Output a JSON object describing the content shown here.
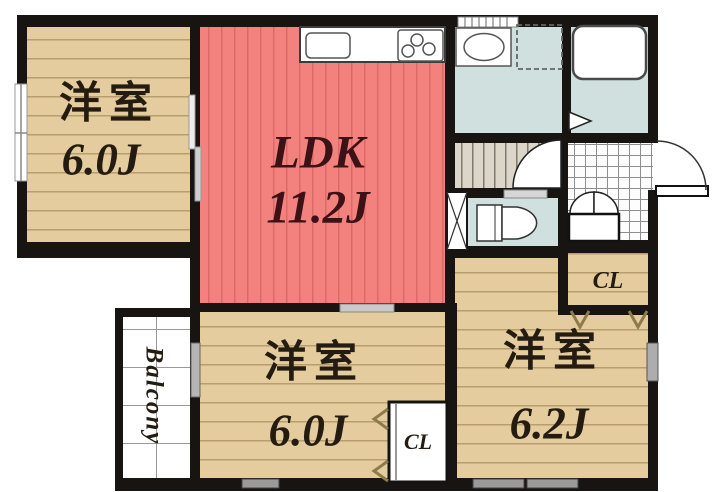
{
  "rooms": {
    "nw": {
      "name": "洋室",
      "area": "6.0J"
    },
    "ldk": {
      "name": "LDK",
      "area": "11.2J"
    },
    "s": {
      "name": "洋室",
      "area": "6.0J"
    },
    "se": {
      "name": "洋室",
      "area": "6.2J"
    }
  },
  "closets": {
    "entry": "CL",
    "south": "CL"
  },
  "balcony": {
    "label": "Balcony"
  },
  "colors": {
    "wall": "#171411",
    "wood_floor": "#e5cc9e",
    "ldk_floor": "#f3827f",
    "wet_area": "#cfe0de",
    "stairs": "#dbd6c8",
    "room_label": "#241c11",
    "ldk_label": "#3c1216",
    "door_arrow": "#8d7b4a"
  },
  "fixtures": [
    "kitchen-counter",
    "kitchen-sink",
    "gas-stove",
    "vanity-sink",
    "washing-machine-space",
    "bathtub",
    "toilet",
    "stairs",
    "entry-tile",
    "front-door",
    "pipe-space",
    "sliding-door",
    "window"
  ]
}
